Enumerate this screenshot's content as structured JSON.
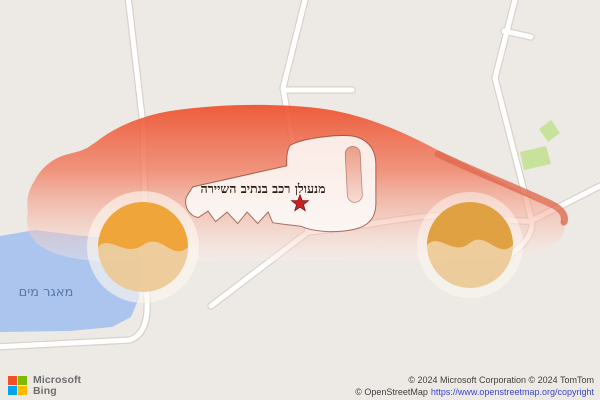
{
  "map": {
    "business_label": "מנעולן רכב בנתיב השיירה",
    "water_label": "מאגר מים",
    "marker": "star-icon"
  },
  "attribution": {
    "brand_line1": "Microsoft",
    "brand_line2": "Bing",
    "copyright_line1": "© 2024 Microsoft Corporation © 2024 TomTom",
    "copyright_line2_prefix": "© OpenStreetMap",
    "copyright_line2_url": "https://www.openstreetmap.org/copyright"
  },
  "colors": {
    "map_background": "#edeae5",
    "water": "#abc5ee",
    "water_label": "#5b79a8",
    "greenery": "#c8e29c",
    "road_fill": "#ffffff",
    "road_casing": "#d8d3ca",
    "car_top": "#ee4f2c",
    "car_mid": "#f07a5e",
    "car_low": "#f6b3a2",
    "car_fade": "#fdf0ec",
    "car_front_edge": "#e0694f",
    "wheel_dark": "#f0a232",
    "wheel_light": "#ecc892",
    "wheel_rear_dark": "#dd9d3b",
    "key_fill": "#fdfbf9",
    "key_outline": "#7d3723",
    "slot_top": "#eb9e88",
    "slot_bottom": "#f8dbd3",
    "star": "#c62222",
    "label_text": "#2c1b12",
    "bing_red": "#f25022",
    "bing_green": "#7fba00",
    "bing_blue": "#00a4ef",
    "bing_yellow": "#ffb900",
    "link": "#3a45cc"
  }
}
